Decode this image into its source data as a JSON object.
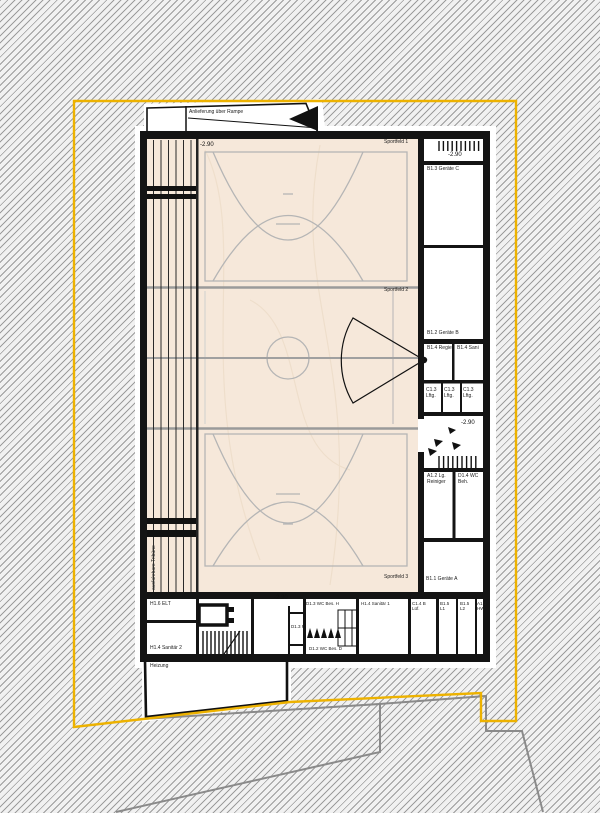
{
  "drawing": {
    "delivery_note": "Anlieferung über Rampe",
    "tribune_label": "ausfahrbare Tribüne",
    "levels": {
      "top_left": "-2.90",
      "top_right": "-2.90",
      "mid_right": "-2.90",
      "bottom": "-2.90"
    },
    "fields": {
      "f1": "Sportfeld 1",
      "f2": "Sportfeld 2",
      "f3": "Sportfeld 3"
    },
    "rooms": {
      "geraete_c": "B1.3 Geräte C",
      "geraete_b": "B1.2 Geräte B",
      "regie": "B1.4 Regie",
      "sani": "B1.4 Sani",
      "lftg1": "C1.3 Lftg.",
      "lftg2": "C1.3 Lftg.",
      "lftg3": "C1.3 Lftg.",
      "reiniger": "A1.2 Lg. Reiniger",
      "wc_beh": "D1.4 WC Beh.",
      "geraete_a": "B1.1 Geräte A",
      "elt": "H1.6 ELT",
      "sanitaer2": "H1.4 Sanitär 2",
      "heizung": "Heizung",
      "flur": "D1.3 F",
      "wc_bes_h": "D1.3 WC Bes. H",
      "wc_bes_d": "D1.2 WC Bes. D",
      "sanitaer1": "H1.4 Sanitär 1",
      "lueftung_b": "C1.4 B Lüf.",
      "b15_l1": "B1.5 L1",
      "b15_l2": "B1.5 L2",
      "hw": "A1.1 HW"
    },
    "colors": {
      "boundary_yellow": "#EDB200",
      "site_grey": "#8A8A8A",
      "court_beige": "#F6E8DA",
      "marking_grey": "#B5B5B5",
      "wall_black": "#141414"
    }
  }
}
